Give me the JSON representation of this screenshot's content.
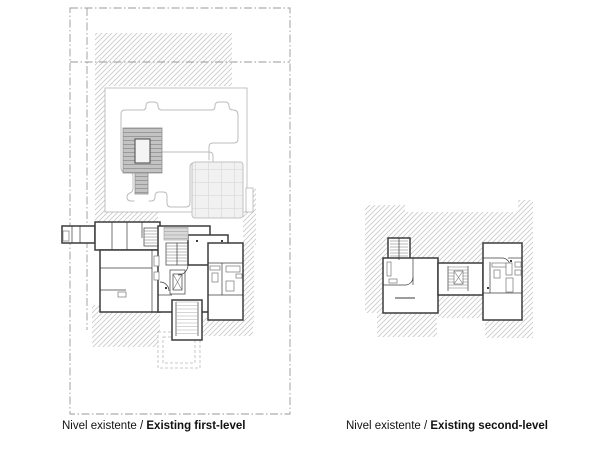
{
  "captions": {
    "first_level": {
      "prefix": "Nivel existente / ",
      "title": "Existing first-level"
    },
    "second_level": {
      "prefix": "Nivel existente / ",
      "title": "Existing second-level"
    }
  },
  "colors": {
    "paper": "#ffffff",
    "caption": "#111111",
    "hatch_line": "#cbcbcb",
    "boundary_line": "#9a9a9a",
    "wall_line": "#3b3b3b",
    "thin_line": "#777777",
    "deck_fill": "#c3c3c3",
    "deck_line": "#909090",
    "deck2_fill": "#d9d9d9",
    "deck2_line": "#a8a8a8",
    "grid_fill": "#f1f1f1",
    "grid_line": "#dcdcdc",
    "path_line": "#bcbcbc",
    "garden_edge": "#b5b5b5",
    "porch_line": "#b9b9b9"
  }
}
